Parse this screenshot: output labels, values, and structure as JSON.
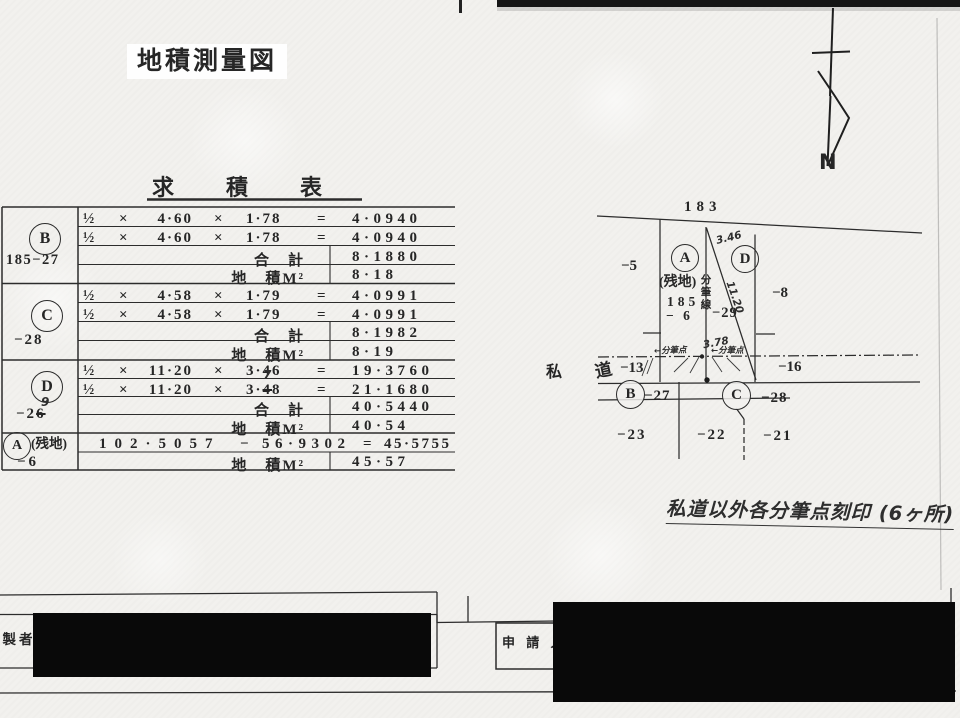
{
  "page": {
    "title": "地積測量図"
  },
  "compass": {
    "north_label": "N"
  },
  "survey_table": {
    "title": "求　積　表",
    "symbols": {
      "half": "½",
      "times": "×",
      "equals": "=",
      "minus": "−"
    },
    "total_label": "合　計",
    "area_label": "地　積M²",
    "blocks": {
      "B": {
        "letter": "B",
        "parcel": "185−27",
        "rows": [
          {
            "a": "4·60",
            "b": "1·78",
            "result": "4·0940"
          },
          {
            "a": "4·60",
            "b": "1·78",
            "result": "4·0940"
          }
        ],
        "total": "8·1880",
        "area": "8·18"
      },
      "C": {
        "letter": "C",
        "parcel": "−28",
        "rows": [
          {
            "a": "4·58",
            "b": "1·79",
            "result": "4·0991"
          },
          {
            "a": "4·58",
            "b": "1·79",
            "result": "4·0991"
          }
        ],
        "total": "8·1982",
        "area": "8·19"
      },
      "D": {
        "letter": "D",
        "parcel_pre": "−2",
        "parcel_struck": "6",
        "parcel_correction": "9",
        "rows": [
          {
            "a": "11·20",
            "b": "3·46",
            "result": "19·3760"
          }
        ],
        "row2": {
          "a": "11·20",
          "b_pre": "3·",
          "b_struck": "4",
          "b_correction": "7",
          "b_post": "8",
          "result": "21·1680"
        },
        "total": "40·5440",
        "area": "40·54"
      },
      "A": {
        "letter": "A",
        "note": "(残地)",
        "parcel": "−6",
        "expr": {
          "minuend": "102·5057",
          "minus": "−",
          "subtrahend": "56·9302",
          "equals": "=",
          "result": "45·5755"
        },
        "area": "45·57"
      }
    }
  },
  "diagram": {
    "top_lot": "183",
    "left_lot": "−5",
    "right_lot": "−8",
    "road_left": "−13",
    "road_right": "−16",
    "bottom_lots": [
      "−23",
      "−22",
      "−21"
    ],
    "parcel_a": {
      "letter": "A",
      "note": "(残地)",
      "lot": "185",
      "sub": "− 6"
    },
    "parcel_d": {
      "letter": "D",
      "sub": "−29"
    },
    "point_b": {
      "letter": "B",
      "sub": "−27"
    },
    "point_c": {
      "letter": "C",
      "sub": "−28"
    },
    "subdivision_line_label": "分筆線",
    "road_label": {
      "shi": "私",
      "do": "道"
    },
    "handwritten": {
      "top_measure": "3.46",
      "diagonal_measure": "11.20",
      "bottom_measure": "3.78",
      "strip_note_left": "←分筆点",
      "strip_note_right": "←分筆点"
    }
  },
  "handwritten_note": "私道以外各分筆点刻印 (6ヶ所)",
  "footer": {
    "maker_label": "作製者",
    "applicant_label": "申 請 人"
  }
}
